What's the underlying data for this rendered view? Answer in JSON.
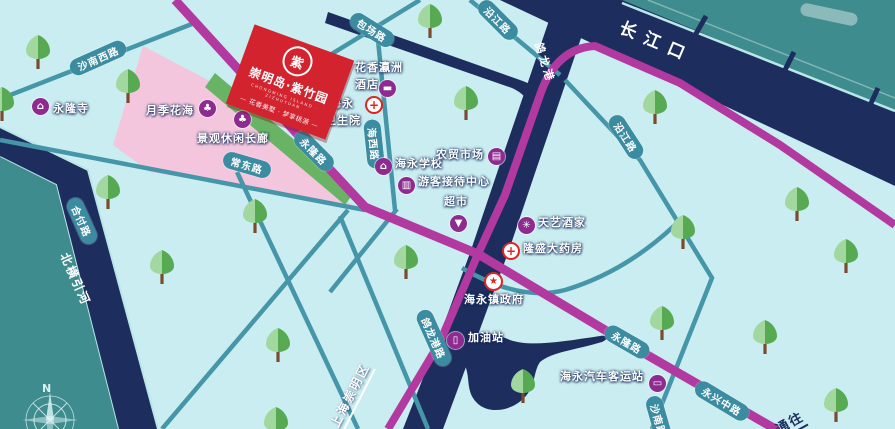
{
  "banner": {
    "title": "崇明岛·紫竹园",
    "subtitle": "CHONGMING ISLAND · ZIZHUYUAN",
    "tagline": "— 花香美墅 · 梦享桃源 —",
    "logo_char": "紫"
  },
  "water": {
    "estuary": "长江口",
    "creek": "鸽龙港",
    "river": "北横引河"
  },
  "misc": {
    "boundary": "上海崇明区",
    "direction": "通往",
    "north": "N"
  },
  "roads": [
    {
      "name": "沙南西路"
    },
    {
      "name": "包场路"
    },
    {
      "name": "沿江路"
    },
    {
      "name": "沿江路"
    },
    {
      "name": "海西路"
    },
    {
      "name": "常东路"
    },
    {
      "name": "永隆路"
    },
    {
      "name": "鸽龙港路"
    },
    {
      "name": "永隆路"
    },
    {
      "name": "永兴中路"
    },
    {
      "name": "沙南路"
    },
    {
      "name": "合付路"
    }
  ],
  "pois": [
    {
      "label": "永隆寺",
      "icon": "temple-icon",
      "glyph": "⌂"
    },
    {
      "label": "月季花海",
      "icon": "tree-icon",
      "glyph": "♣"
    },
    {
      "label": "景观休闲长廊",
      "icon": "tree-icon",
      "glyph": "♣"
    },
    {
      "label": "花香瀛洲",
      "label2": "酒店",
      "icon": "hotel-bed-icon",
      "glyph": "▬"
    },
    {
      "label": "海永",
      "label2": "卫生院",
      "icon": "medical-cross-icon",
      "glyph": "+"
    },
    {
      "label": "海永学校",
      "icon": "school-icon",
      "glyph": "⌂"
    },
    {
      "label": "农贸市场",
      "icon": "market-icon",
      "glyph": "▤"
    },
    {
      "label": "游客接待中心",
      "icon": "reception-icon",
      "glyph": "▥"
    },
    {
      "label": "超市",
      "icon": "shopping-bag-icon",
      "glyph": "▼"
    },
    {
      "label": "天艺酒家",
      "icon": "flower-icon",
      "glyph": "✳"
    },
    {
      "label": "隆盛大药房",
      "icon": "pharmacy-cross-icon",
      "glyph": "+"
    },
    {
      "label": "海永镇政府",
      "icon": "government-star-icon",
      "glyph": "★"
    },
    {
      "label": "加油站",
      "icon": "fuel-pump-icon",
      "glyph": "▯"
    },
    {
      "label": "海永汽车客运站",
      "icon": "bus-icon",
      "glyph": "▭"
    }
  ],
  "colors": {
    "land": "#c9edf0",
    "far_land": "#3e8c8e",
    "water_navy": "#1d2d5e",
    "road_magenta": "#b2399f",
    "road_teal": "#4596a8",
    "capsule_teal": "#3b8ba1",
    "flower_field_pink": "#f3c6de",
    "corridor_green": "#68b464",
    "banner_red": "#d2232e",
    "poi_purple": "#8e2b91"
  }
}
